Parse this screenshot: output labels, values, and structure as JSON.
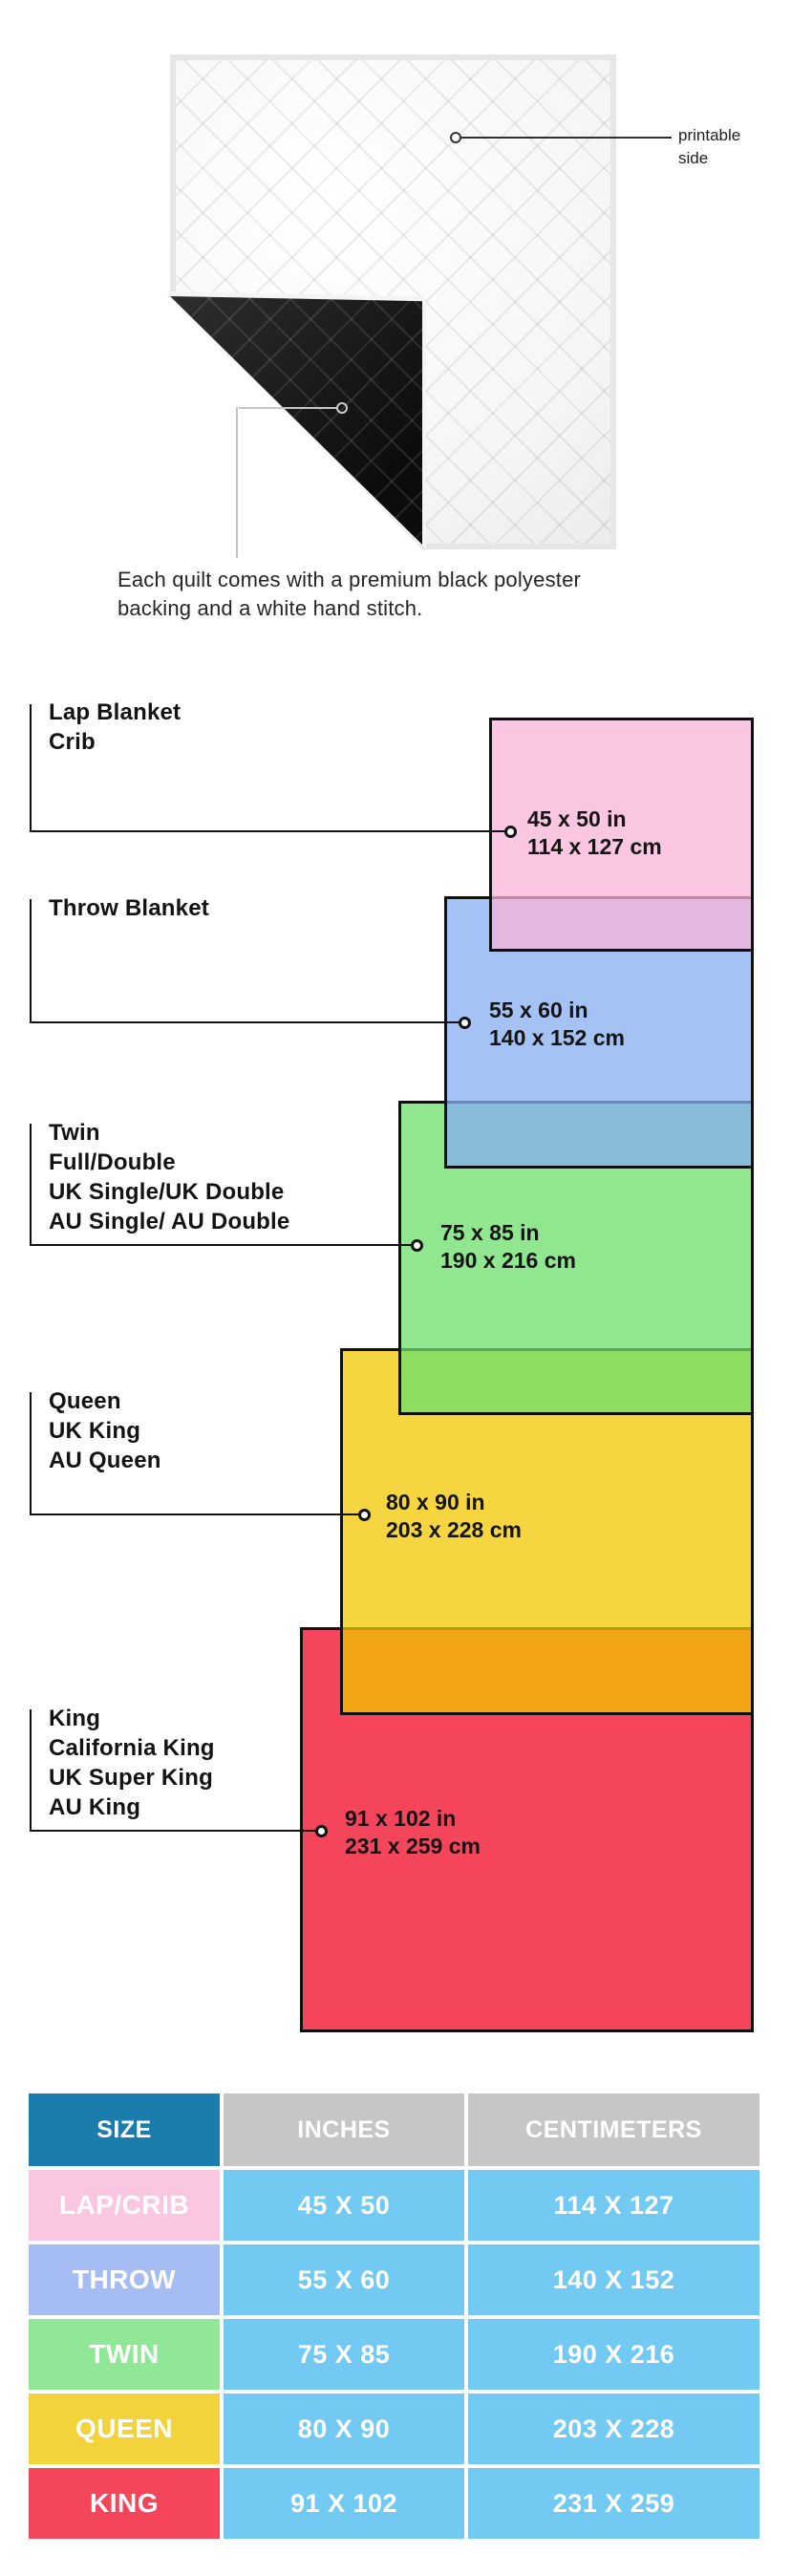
{
  "quilt": {
    "printable_label": [
      "printable",
      "side"
    ],
    "caption": [
      "Each quilt comes with a premium black polyester",
      "backing and a white hand stitch."
    ]
  },
  "diagram": {
    "items": [
      {
        "id": "lap",
        "labels": [
          "Lap Blanket",
          "Crib"
        ],
        "inches": "45 x 50 in",
        "cm": "114 x 127 cm",
        "color": "#fbc6e1"
      },
      {
        "id": "throw",
        "labels": [
          "Throw Blanket"
        ],
        "inches": "55 x 60 in",
        "cm": "140 x 152 cm",
        "color": "#a4c2f4"
      },
      {
        "id": "twin",
        "labels": [
          "Twin",
          "Full/Double",
          "UK Single/UK Double",
          "AU Single/ AU Double"
        ],
        "inches": "75 x 85 in",
        "cm": "190 x 216 cm",
        "color": "#90e790"
      },
      {
        "id": "queen",
        "labels": [
          "Queen",
          "UK King",
          "AU Queen"
        ],
        "inches": "80 x 90 in",
        "cm": "203 x 228 cm",
        "color": "#f5d535"
      },
      {
        "id": "king",
        "labels": [
          "King",
          "California King",
          "UK Super King",
          "AU King"
        ],
        "inches": "91 x 102 in",
        "cm": "231 x 259 cm",
        "color": "#f4455a"
      }
    ],
    "outline_color": "#101010"
  },
  "table": {
    "headers": [
      "SIZE",
      "INCHES",
      "CENTIMETERS"
    ],
    "header_colors": {
      "size_bg": "#1b7dae",
      "metric_bg": "#c6c6c6"
    },
    "cell_bg": "#72caf3",
    "rows": [
      {
        "size": "LAP/CRIB",
        "inches": "45 X 50",
        "centimeters": "114 X 127",
        "color": "#fbc6e1"
      },
      {
        "size": "THROW",
        "inches": "55 X 60",
        "centimeters": "140 X 152",
        "color": "#a6bdf4"
      },
      {
        "size": "TWIN",
        "inches": "75 X 85",
        "centimeters": "190 X 216",
        "color": "#90e795"
      },
      {
        "size": "QUEEN",
        "inches": "80 X 90",
        "centimeters": "203 X 228",
        "color": "#f2d33c"
      },
      {
        "size": "KING",
        "inches": "91 X 102",
        "centimeters": "231 X 259",
        "color": "#f4455a"
      }
    ]
  }
}
